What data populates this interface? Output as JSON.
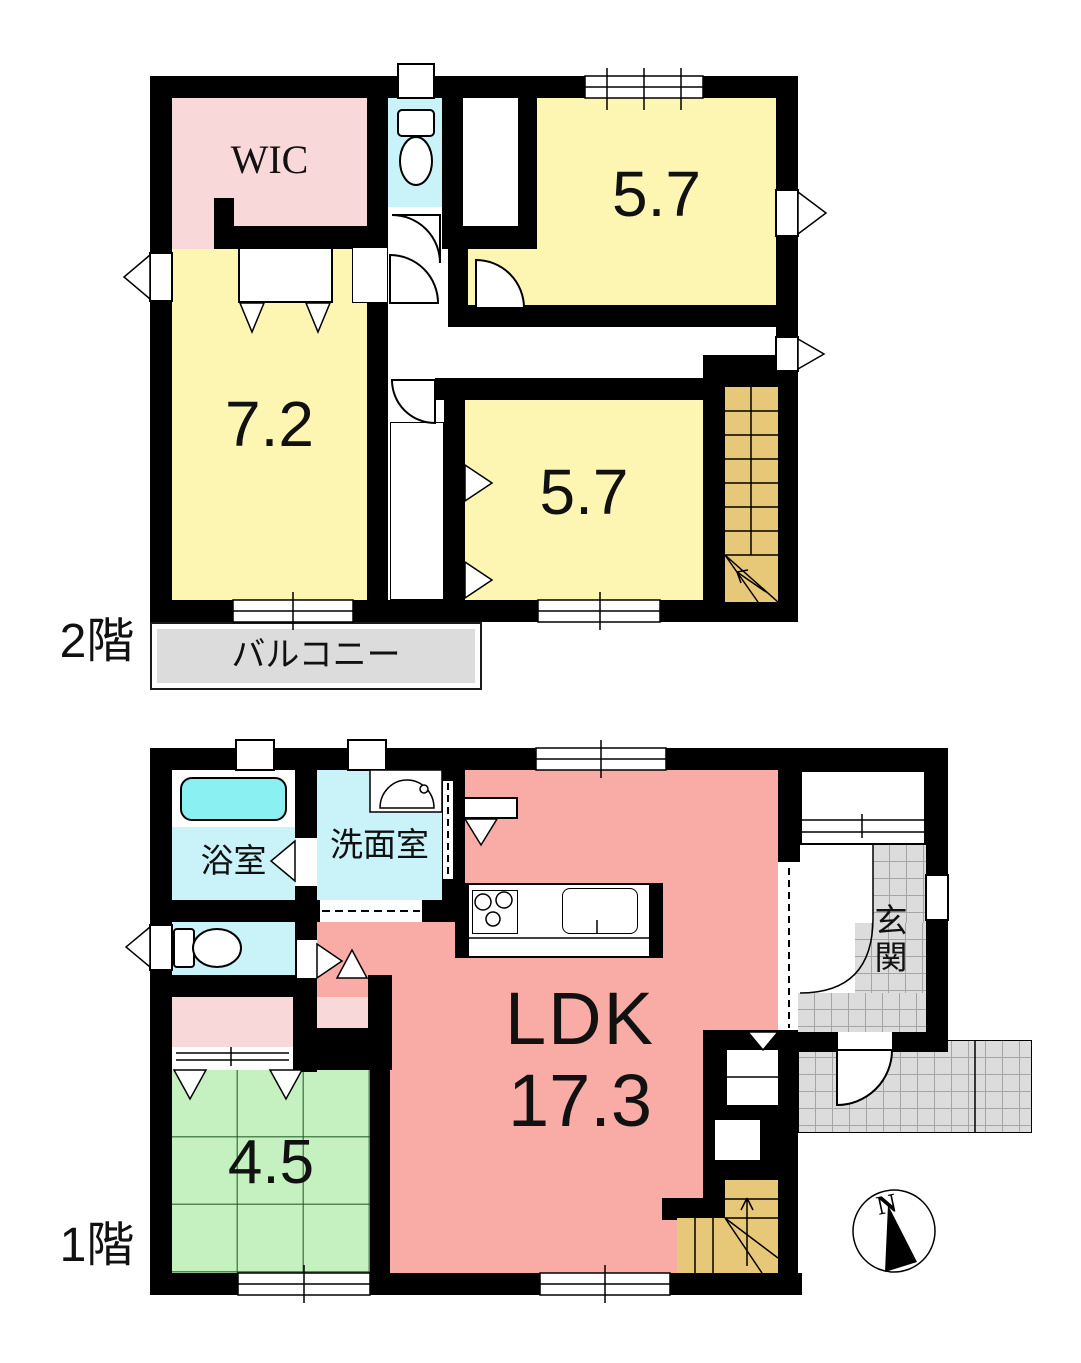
{
  "floor2": {
    "label": "2階",
    "wic": "WIC",
    "room_5_7_top": "5.7",
    "room_7_2": "7.2",
    "room_5_7_bottom": "5.7",
    "balcony": "バルコニー"
  },
  "floor1": {
    "label": "1階",
    "bath": "浴室",
    "washroom": "洗面室",
    "ldk": "LDK",
    "ldk_area": "17.3",
    "tatami": "4.5",
    "entrance": "玄関"
  },
  "compass": {
    "north": "N"
  },
  "colors": {
    "wall": "#000000",
    "room-yellow": "#FCF6B2",
    "room-pink": "#F9D8D9",
    "room-salmon": "#F9ACA6",
    "room-green": "#C4F1BF",
    "room-cyan": "#C9F3F8",
    "bathtub-cyan": "#8BF0F1",
    "stairs-tan": "#E7C878",
    "tile-gray": "#DCDCDC",
    "grid-line": "#A5A5A5"
  }
}
